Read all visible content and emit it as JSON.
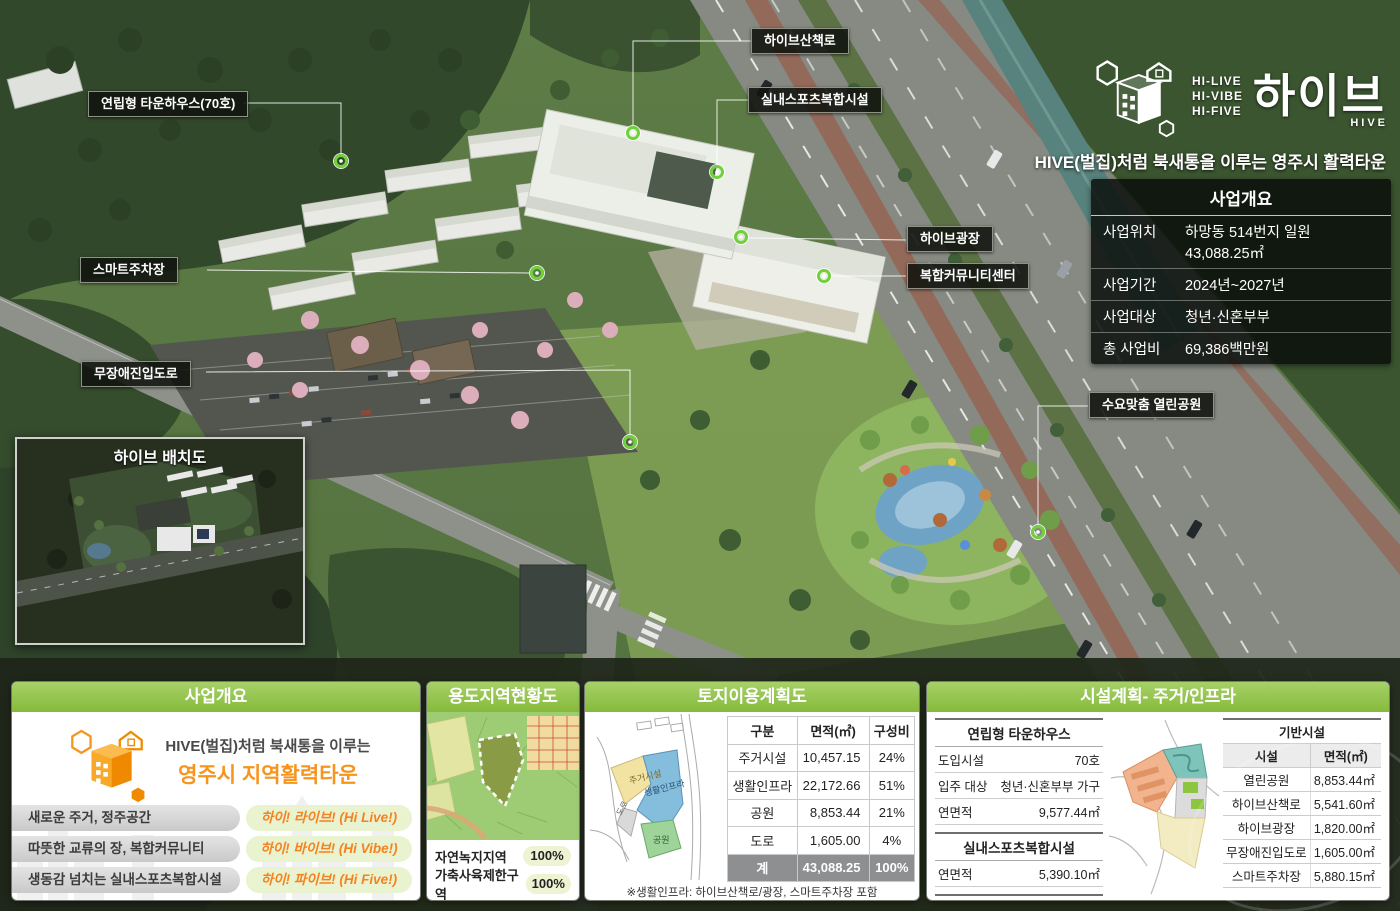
{
  "logo": {
    "hi_lines": [
      "HI-LIVE",
      "HI-VIBE",
      "HI-FIVE"
    ],
    "title_ko": "하이브",
    "title_en": "HIVE"
  },
  "tagline": "HIVE(벌집)처럼 북새통을 이루는 영주시 활력타운",
  "overview_box": {
    "title": "사업개요",
    "rows": [
      {
        "label": "사업위치",
        "value": "하망동 514번지 일원  43,088.25㎡"
      },
      {
        "label": "사업기간",
        "value": "2024년~2027년"
      },
      {
        "label": "사업대상",
        "value": "청년·신혼부부"
      },
      {
        "label": "총 사업비",
        "value": "69,386백만원"
      }
    ]
  },
  "callouts": [
    {
      "label": "연립형 타운하우스(70호)"
    },
    {
      "label": "하이브산책로"
    },
    {
      "label": "실내스포츠복합시설"
    },
    {
      "label": "스마트주차장"
    },
    {
      "label": "하이브광장"
    },
    {
      "label": "복합커뮤니티센터"
    },
    {
      "label": "무장애진입도로"
    },
    {
      "label": "수요맞춤 열린공원"
    }
  ],
  "inset": {
    "title": "하이브 배치도"
  },
  "panels": {
    "overview": {
      "title": "사업개요",
      "intro_line1": "HIVE(벌집)처럼 북새통을 이루는",
      "intro_line2": "영주시 지역활력타운",
      "rows": [
        {
          "left": "새로운 주거, 정주공간",
          "right": "하이! 라이브! (Hi Live!)"
        },
        {
          "left": "따뜻한 교류의 장, 복합커뮤니티",
          "right": "하이! 바이브! (Hi Vibe!)"
        },
        {
          "left": "생동감 넘치는 실내스포츠복합시설",
          "right": "하이! 파이브! (Hi Five!)"
        }
      ]
    },
    "zoning": {
      "title": "용도지역현황도",
      "rows": [
        {
          "label": "자연녹지지역",
          "value": "100%"
        },
        {
          "label": "가축사육제한구역",
          "value": "100%"
        }
      ]
    },
    "landuse": {
      "title": "토지이용계획도",
      "diagram_labels": [
        "주거시설",
        "생활인프라",
        "도로",
        "공원"
      ],
      "table": {
        "headers": [
          "구분",
          "면적(㎡)",
          "구성비"
        ],
        "rows": [
          [
            "주거시설",
            "10,457.15",
            "24%"
          ],
          [
            "생활인프라",
            "22,172.66",
            "51%"
          ],
          [
            "공원",
            "8,853.44",
            "21%"
          ],
          [
            "도로",
            "1,605.00",
            "4%"
          ]
        ],
        "total": [
          "계",
          "43,088.25",
          "100%"
        ]
      },
      "footnote": "※생활인프라: 하이브산책로/광장, 스마트주차장 포함"
    },
    "facilities": {
      "title": "시설계획- 주거/인프라",
      "townhouse": {
        "title": "연립형 타운하우스",
        "rows": [
          {
            "label": "도입시설",
            "value": "70호"
          },
          {
            "label": "입주 대상",
            "value": "청년·신혼부부 가구"
          },
          {
            "label": "연면적",
            "value": "9,577.44㎡"
          }
        ]
      },
      "sports": {
        "title": "실내스포츠복합시설",
        "rows": [
          {
            "label": "연면적",
            "value": "5,390.10㎡"
          }
        ]
      },
      "community": {
        "title": "복합커뮤니티센터",
        "rows": [
          {
            "label": "연면적",
            "value": "3,336.95㎡"
          }
        ]
      },
      "infra": {
        "title": "기반시설",
        "headers": [
          "시설",
          "면적(㎡)"
        ],
        "rows": [
          [
            "열린공원",
            "8,853.44㎡"
          ],
          [
            "하이브산책로",
            "5,541.60㎡"
          ],
          [
            "하이브광장",
            "1,820.00㎡"
          ],
          [
            "무장애진입도로",
            "1,605.00㎡"
          ],
          [
            "스마트주차장",
            "5,880.15㎡"
          ]
        ]
      }
    }
  },
  "colors": {
    "header_green": "#8cbf47",
    "accent_orange": "#f58220",
    "pill_green": "#eaf3cf",
    "callout_bg": "#10120e"
  }
}
